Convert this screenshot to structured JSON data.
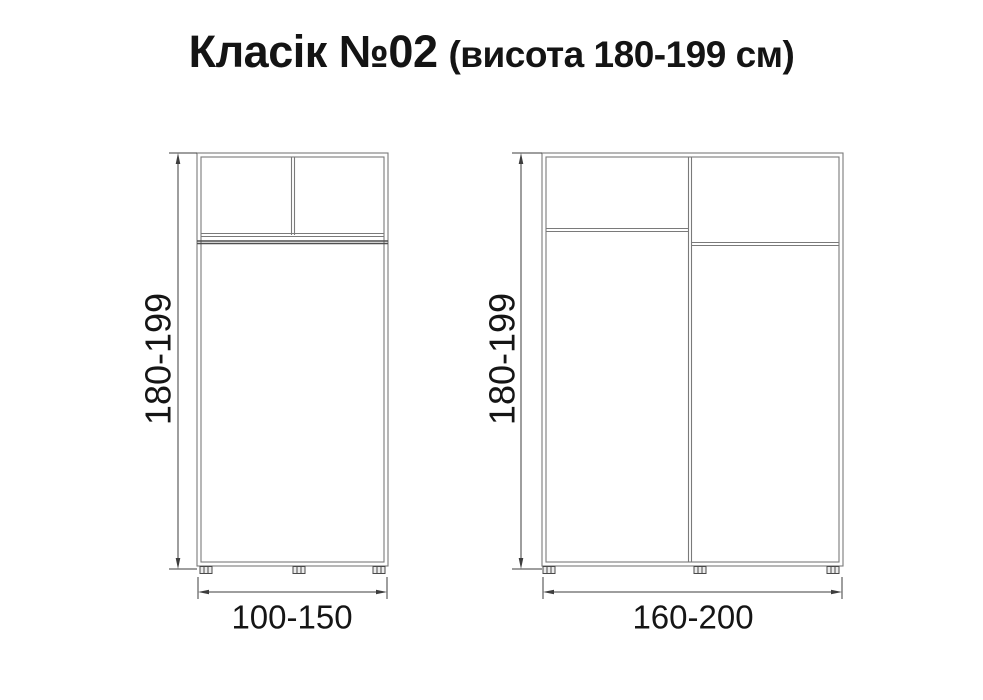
{
  "title": {
    "text": "Класік №02",
    "subtitle": "(висота 180-199 см)"
  },
  "colors": {
    "background": "#ffffff",
    "cabinet_line": "#7a7a7a",
    "cabinet_line_dark": "#4f4f4f",
    "dimension_line": "#3d3d3d",
    "label_text": "#151515"
  },
  "diagrams": [
    {
      "height_label": "180-199",
      "width_label": "100-150"
    },
    {
      "height_label": "180-199",
      "width_label": "160-200"
    }
  ]
}
